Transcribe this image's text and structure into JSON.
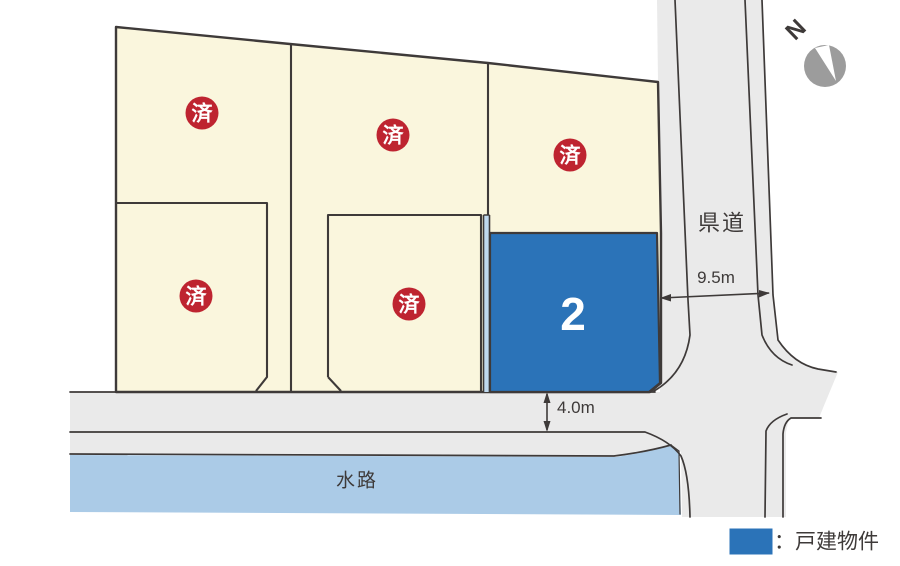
{
  "map": {
    "labels": {
      "sold_badge": "済",
      "available_number": "2",
      "prefectural_road": "県道",
      "waterway": "水路",
      "north": "N"
    },
    "dimensions": {
      "prefectural_road_width": "9.5m",
      "front_road_width": "4.0m"
    },
    "legend": {
      "label": "：戸建物件"
    },
    "colors": {
      "background": "#FFFFFF",
      "lot_bg": "#FAF6DD",
      "lot_available": "#2B73B8",
      "sold_badge": "#BE2430",
      "badge_text": "#FFFFFF",
      "road": "#EAEAEA",
      "waterway": "#ABCBE7",
      "walkway_strip": "#BFD9EF",
      "outline": "#3E3A39",
      "text": "#3E3A39",
      "compass": "#9C9C9C"
    }
  }
}
